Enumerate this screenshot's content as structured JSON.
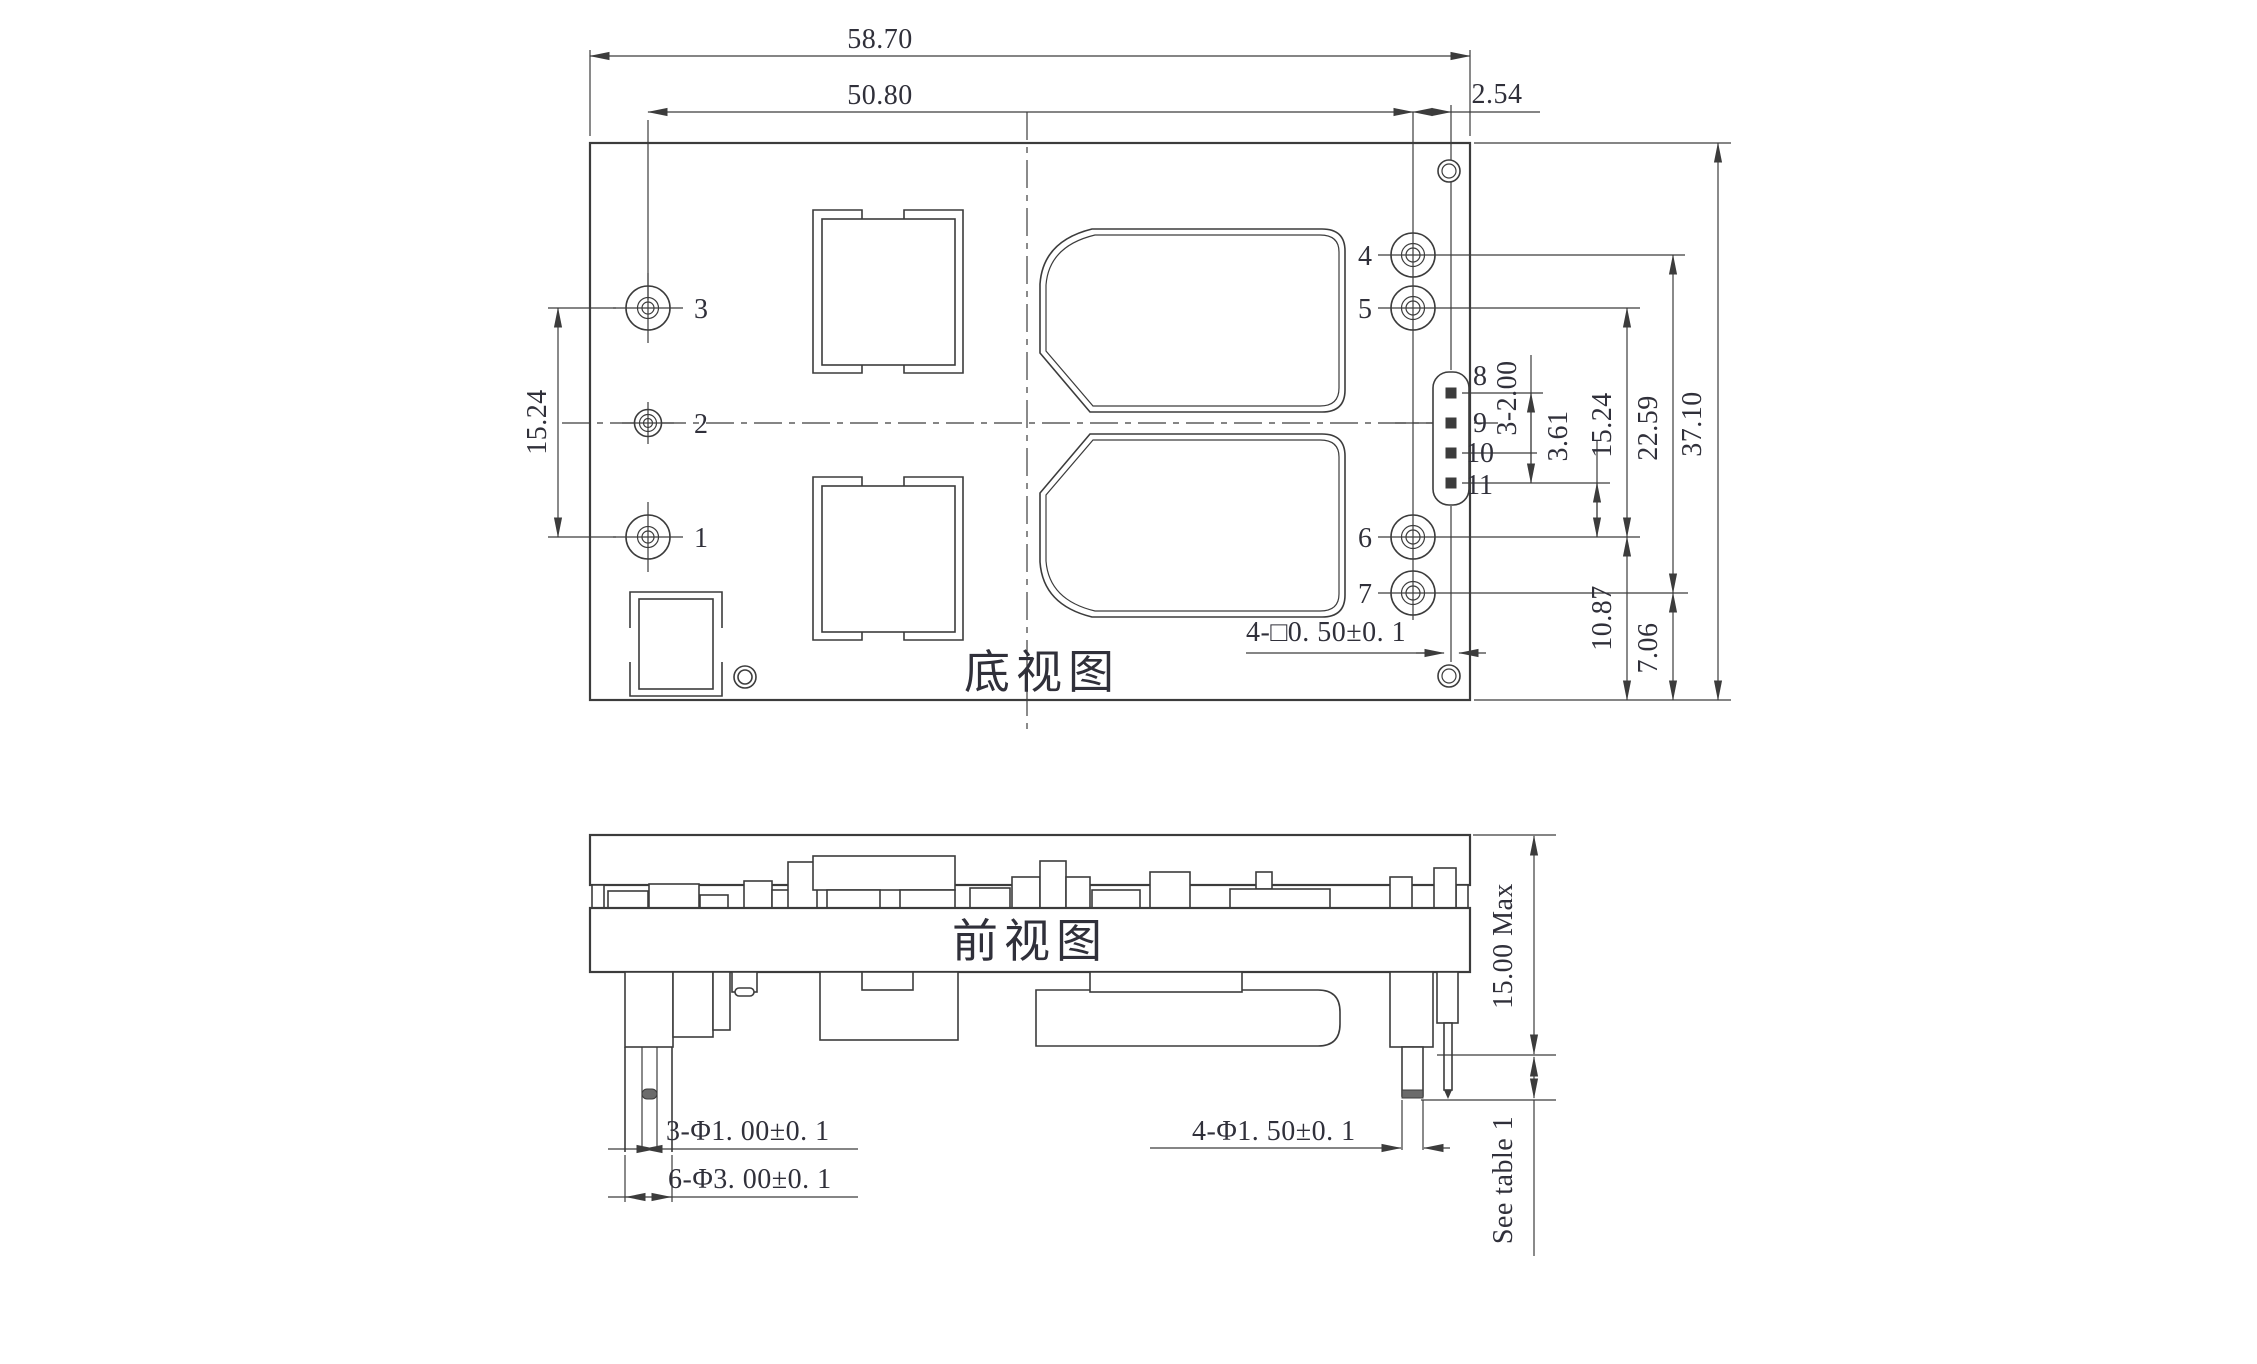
{
  "colors": {
    "line": "#3c3c3c",
    "text": "#30303a",
    "background": "#ffffff",
    "pin_fill": "#3c3c3c",
    "solder_tip_fill": "#6b6b6b"
  },
  "bottom_view": {
    "label": "底视图",
    "pin_labels": [
      "1",
      "2",
      "3",
      "4",
      "5",
      "6",
      "7",
      "8",
      "9",
      "10",
      "11"
    ],
    "dims": {
      "overall_width": "58.70",
      "pin_span_width": "50.80",
      "signal_offset": "2.54",
      "left_pin_span": "15.24",
      "signal_pitch": "3-2.00",
      "sig_to_pin6": "3.61",
      "pin5_to_pin6": "15.24",
      "pin6_to_edge": "10.87",
      "pin4_to_pin7": "22.59",
      "pin7_to_edge": "7.06",
      "overall_height": "37.10",
      "square_pin_note": "4-□0. 50±0. 1"
    }
  },
  "front_view": {
    "label": "前视图",
    "dims": {
      "input_pin_dia": "3-Φ1. 00±0. 1",
      "standoff_dia": "6-Φ3. 00±0. 1",
      "output_pin_dia": "4-Φ1. 50±0. 1",
      "max_height": "15.00 Max",
      "pin_length_note": "See table 1"
    }
  }
}
